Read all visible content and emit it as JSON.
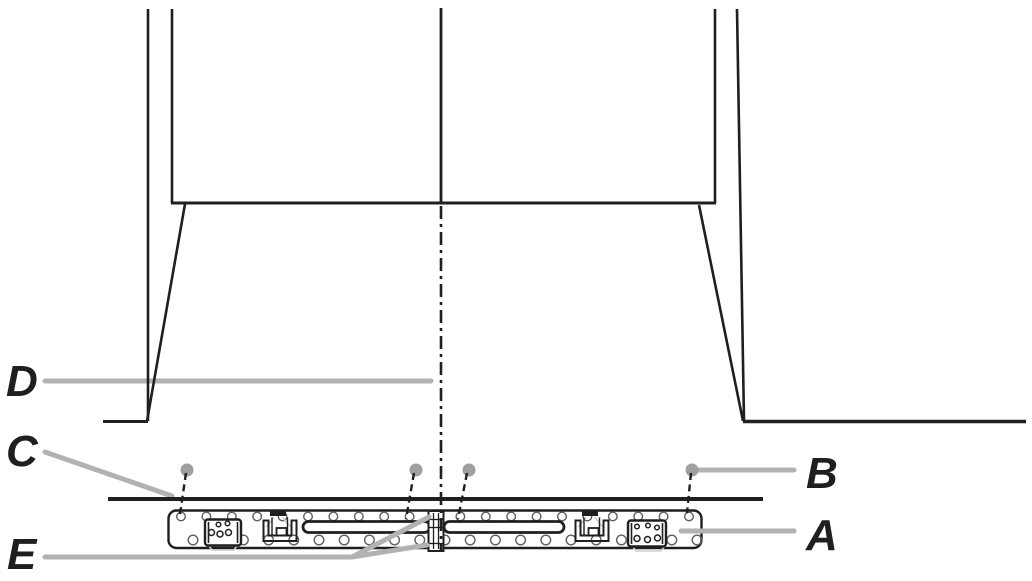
{
  "canvas": {
    "width": 1032,
    "height": 581,
    "background": "#ffffff"
  },
  "colors": {
    "line": "#1f1f1f",
    "leader_gray": "#b2b2b2",
    "screw_dot_gray": "#9f9f9f",
    "ghost_gray": "#cfcfcf",
    "hole_outline": "#5f5f5f",
    "surface": "#ffffff"
  },
  "labels": {
    "d": "D",
    "c": "C",
    "e": "E",
    "b": "B",
    "a": "A"
  },
  "rail": {
    "holes_top": {
      "y": 516.5,
      "r": 4.3,
      "start_x": 181,
      "step": 25.4,
      "count": 21
    },
    "holes_bottom": {
      "y": 540,
      "r": 4.8,
      "start_x": 193,
      "step": 25.2,
      "count": 21
    }
  },
  "screw_dots": [
    {
      "x": 187,
      "y": 470
    },
    {
      "x": 416,
      "y": 470
    },
    {
      "x": 469,
      "y": 470
    },
    {
      "x": 692,
      "y": 470
    }
  ],
  "dashed_leaders": [
    {
      "x1": 186,
      "y1": 473,
      "x2": 180,
      "y2": 514
    },
    {
      "x1": 414,
      "y1": 473,
      "x2": 406,
      "y2": 519
    },
    {
      "x1": 467,
      "y1": 473,
      "x2": 458,
      "y2": 519
    },
    {
      "x1": 691,
      "y1": 473,
      "x2": 687,
      "y2": 513
    }
  ]
}
